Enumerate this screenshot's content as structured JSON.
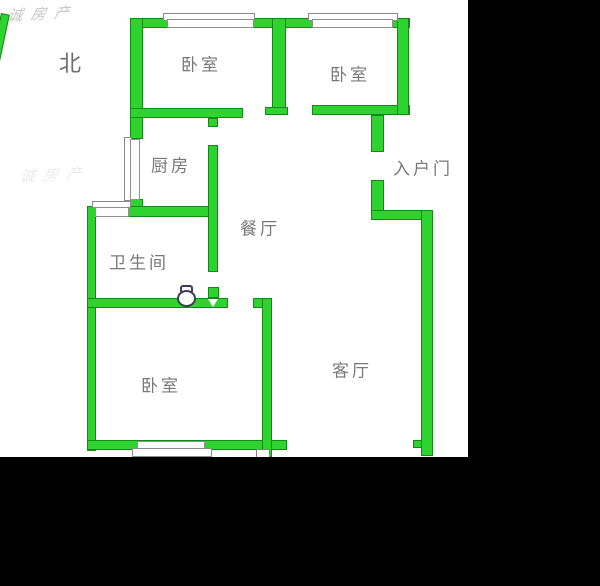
{
  "watermark": {
    "text": "诚房产",
    "text_faint": "诚房产"
  },
  "compass": {
    "north_label": "北"
  },
  "rooms": {
    "bedroom_top_left": "卧室",
    "bedroom_top_right": "卧室",
    "kitchen": "厨房",
    "entry_door": "入户门",
    "dining": "餐厅",
    "bathroom": "卫生间",
    "bedroom_bottom": "卧室",
    "living": "客厅"
  },
  "icons": {
    "toilet": "toilet-top-view-icon",
    "north_line": "north-direction-line",
    "door_arrow": "door-opening-arrow-icon"
  },
  "colors": {
    "wall_fill": "#2ed330",
    "wall_outline": "#128a14",
    "sheet_background": "#ffffff",
    "letterbox": "#000000",
    "label_text": "#787878",
    "watermark_text": "#c6c6c6",
    "toilet_outline": "#3b3b5c"
  }
}
